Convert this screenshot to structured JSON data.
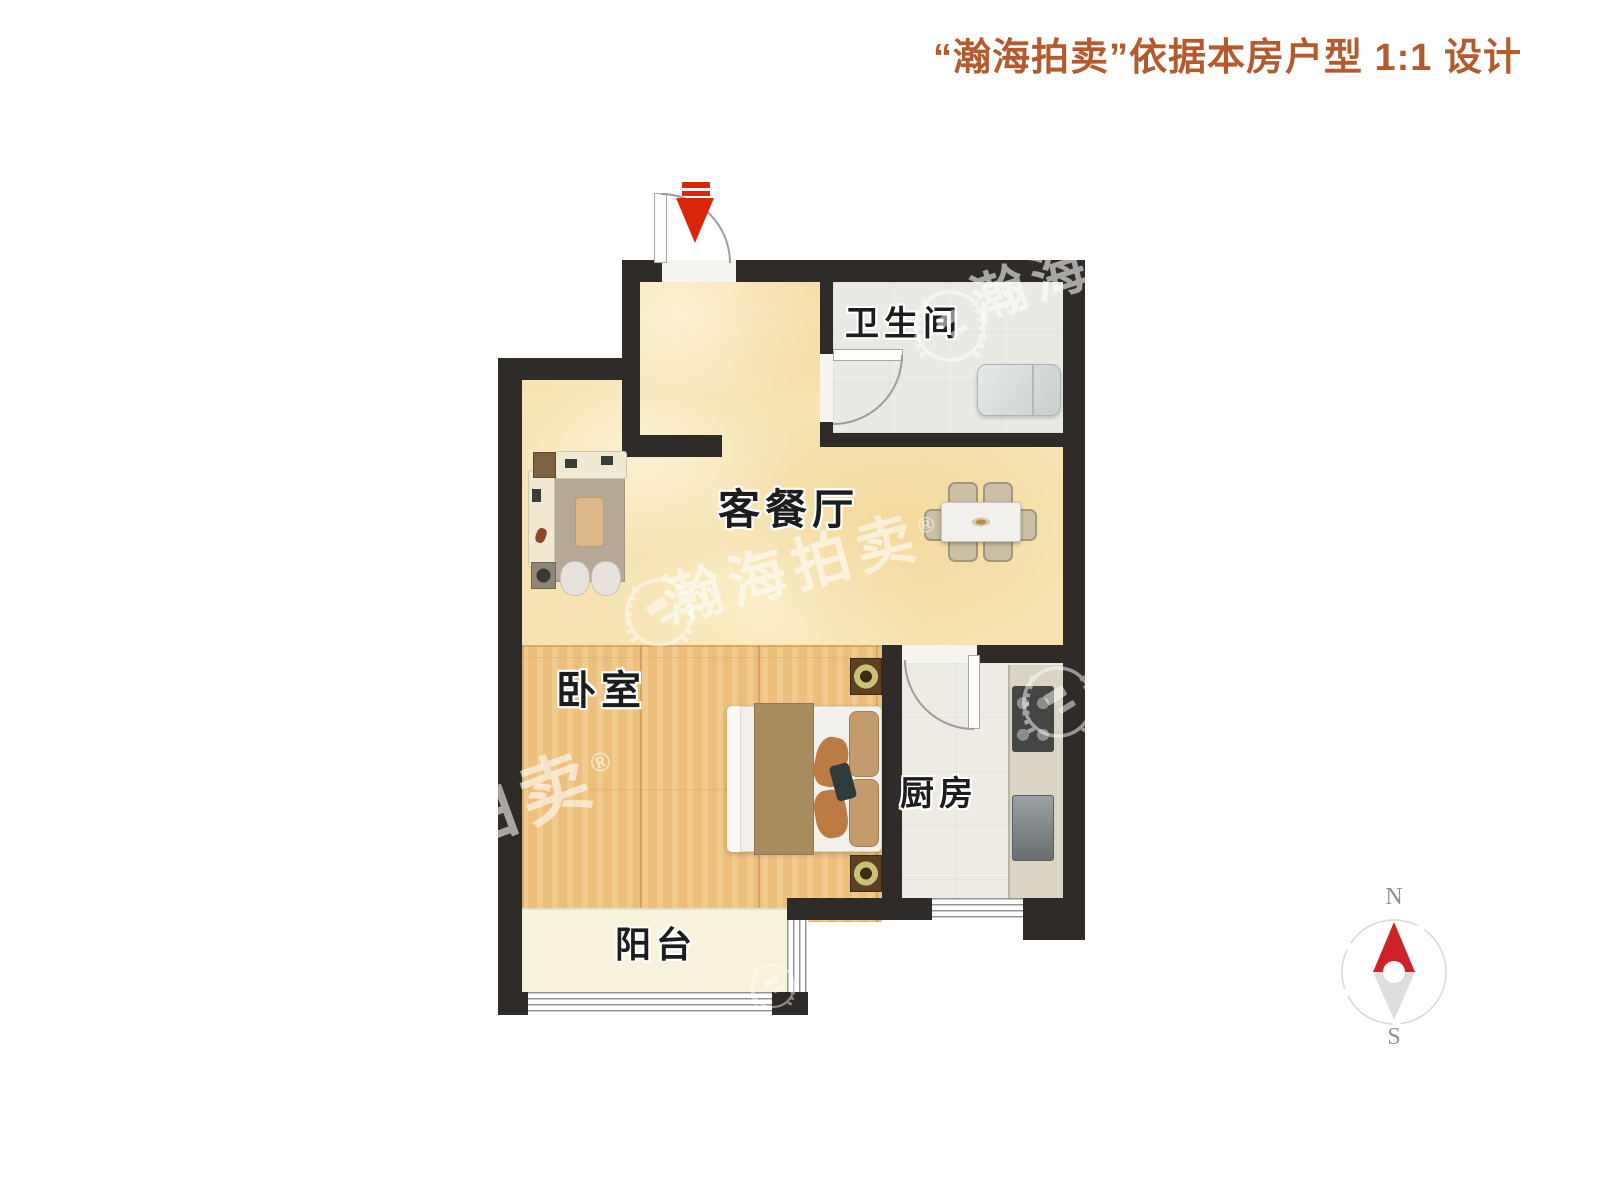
{
  "header": {
    "title": "“瀚海拍卖”依据本房户型 1:1 设计"
  },
  "rooms": {
    "bathroom": "卫生间",
    "living_dining": "客餐厅",
    "bedroom": "卧室",
    "kitchen": "厨房",
    "balcony": "阳台"
  },
  "compass": {
    "north_label": "N",
    "south_label": "S"
  },
  "watermarks": {
    "brand_full": "瀚海拍卖",
    "brand_partial_top": "瀚海",
    "brand_partial_bed": "拍卖",
    "registered_mark": "®"
  },
  "colors": {
    "wall": "#2e2b28",
    "accent_red": "#da2608",
    "header_text": "#b45a2c",
    "living_floor": "#f6e3b1",
    "bedroom_floor": "#ecbf7d",
    "balcony_floor": "#f8f3dd",
    "bathroom_floor": "#eaeae5",
    "kitchen_floor": "#edebe3",
    "compass_north": "#ce2128"
  }
}
